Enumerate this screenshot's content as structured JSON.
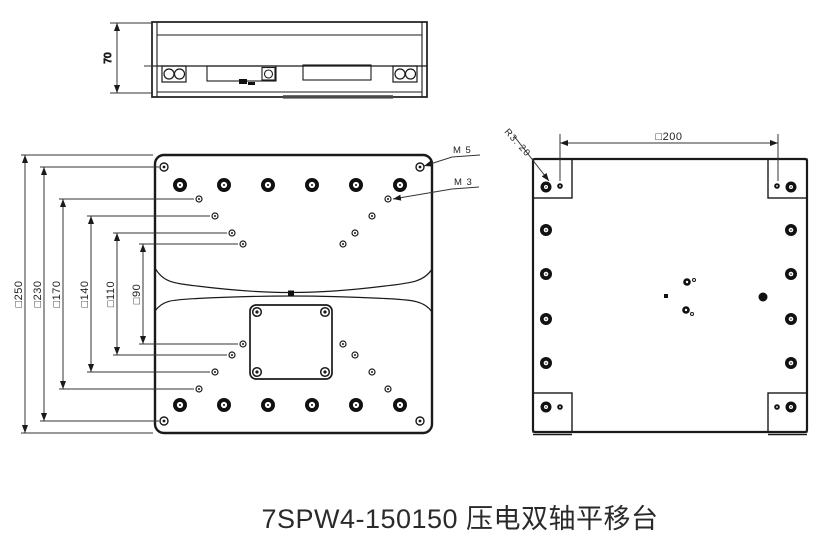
{
  "caption": "7SPW4-150150 压电双轴平移台",
  "side_view": {
    "height_dim_label": "70"
  },
  "top_view": {
    "dim_labels": [
      "□250",
      "□230",
      "□170",
      "□140",
      "□110",
      "□90"
    ],
    "thread_callout_m5": "M 5",
    "thread_callout_m3": "M 3"
  },
  "bottom_view": {
    "width_dim_label": "□200",
    "corner_radius_callout": "R3. 20"
  },
  "colors": {
    "line": "#1a1a1a",
    "dim_line": "#333333",
    "background": "#ffffff",
    "text": "#222222"
  }
}
